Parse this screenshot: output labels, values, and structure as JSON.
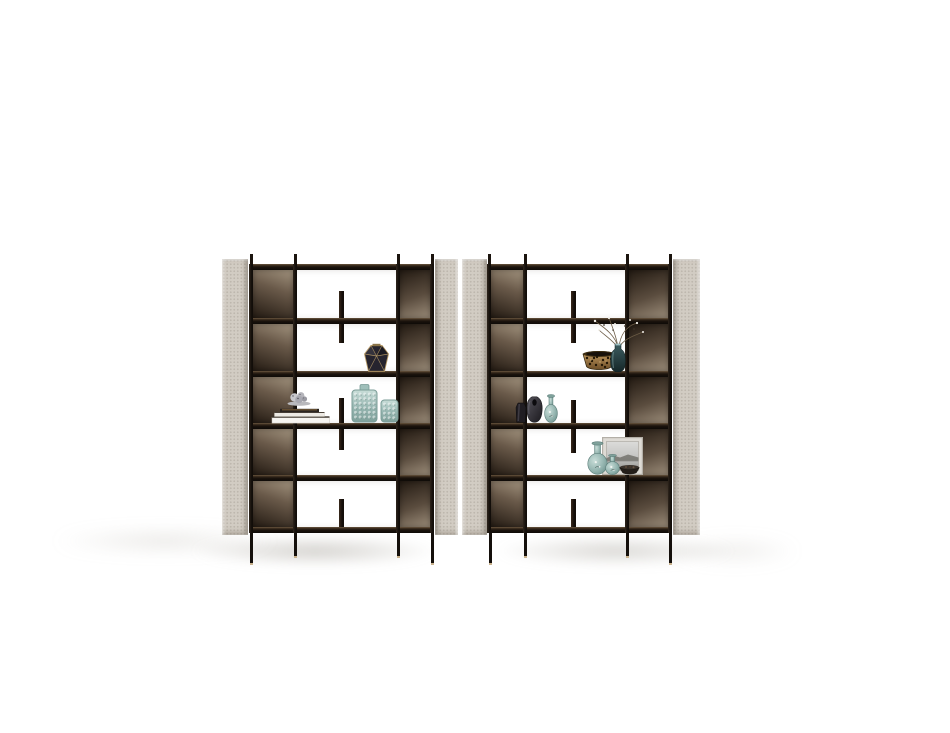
{
  "scene": {
    "subject": "product-photo-two-modern-bookcase-units-with-decor",
    "background": "#ffffff"
  },
  "palette": {
    "panel_fabric": "#d2ccc3",
    "frame_dark": "#171210",
    "bronze_light": "#a3947f",
    "bronze_dark": "#241b13",
    "teal_light": "#c8ddd8",
    "teal_mid": "#95b5b0",
    "teal_dark": "#5f837e",
    "gold": "#b79a66",
    "leg_foot": "#c9b28d"
  },
  "metrics": {
    "canvas_w": 950,
    "canvas_h": 733,
    "rail_ys": [
      264,
      318,
      371,
      423,
      475,
      527
    ],
    "rail_h": 6,
    "post_w": 4,
    "divider_w": 5,
    "stub_h": 10,
    "panel_top": 259,
    "panel_bottom": 535,
    "leg_top": 533
  },
  "shadows": [
    {
      "x": 150,
      "y": 530,
      "w": 330,
      "h": 42,
      "color": "rgba(148,143,133,0.40)",
      "blur": 5
    },
    {
      "x": 455,
      "y": 530,
      "w": 320,
      "h": 42,
      "color": "rgba(148,143,133,0.34)",
      "blur": 5
    },
    {
      "x": 15,
      "y": 526,
      "w": 300,
      "h": 30,
      "color": "rgba(170,165,155,0.30)",
      "blur": 8
    },
    {
      "x": 650,
      "y": 534,
      "w": 170,
      "h": 34,
      "color": "rgba(170,165,155,0.22)",
      "blur": 8
    }
  ],
  "units": [
    {
      "id": "bookcase-left",
      "side_panels": [
        {
          "x": 222,
          "w": 26,
          "flip": false
        },
        {
          "x": 435,
          "w": 23,
          "flip": true
        }
      ],
      "posts": [
        249,
        293,
        396,
        430
      ],
      "rail_x": 249,
      "rail_w": 185,
      "bronze_columns": [
        {
          "x": 253,
          "w": 40,
          "light": "top"
        },
        {
          "x": 400,
          "w": 30,
          "light": "bottom"
        }
      ],
      "middle": {
        "x": 297,
        "w": 99
      },
      "dividers": [
        {
          "x": 339,
          "y": 291,
          "h": 52
        },
        {
          "x": 339,
          "y": 398,
          "h": 52
        },
        {
          "x": 339,
          "y": 499,
          "h": 28
        }
      ],
      "legs": [
        {
          "x": 250,
          "h": 30
        },
        {
          "x": 294,
          "h": 23
        },
        {
          "x": 397,
          "h": 23
        },
        {
          "x": 431,
          "h": 30
        }
      ]
    },
    {
      "id": "bookcase-right",
      "side_panels": [
        {
          "x": 462,
          "w": 25,
          "flip": false
        },
        {
          "x": 673,
          "w": 27,
          "flip": true
        }
      ],
      "posts": [
        487,
        523,
        625,
        668
      ],
      "rail_x": 487,
      "rail_w": 185,
      "bronze_columns": [
        {
          "x": 491,
          "w": 32,
          "light": "top"
        },
        {
          "x": 629,
          "w": 39,
          "light": "bottom"
        }
      ],
      "middle": {
        "x": 527,
        "w": 98
      },
      "dividers": [
        {
          "x": 571,
          "y": 291,
          "h": 52
        },
        {
          "x": 571,
          "y": 400,
          "h": 53
        },
        {
          "x": 571,
          "y": 499,
          "h": 28
        }
      ],
      "legs": [
        {
          "x": 489,
          "h": 30
        },
        {
          "x": 524,
          "h": 23
        },
        {
          "x": 626,
          "h": 23
        },
        {
          "x": 669,
          "h": 30
        }
      ]
    }
  ],
  "objects": [
    {
      "id": "faceted-vase",
      "type": "facetedVase",
      "x": 363,
      "y": 343,
      "w": 27,
      "h": 29,
      "body": "#26242e",
      "edge": "#b79a66"
    },
    {
      "id": "book-stack",
      "type": "bookStack",
      "x": 271,
      "y": 404,
      "w": 60,
      "h": 20,
      "c1": "#f6f4f0",
      "c2": "#2b2520",
      "c3": "#8a6a3e"
    },
    {
      "id": "silver-sculpture",
      "type": "sculpture",
      "x": 284,
      "y": 390,
      "w": 30,
      "h": 16,
      "c1": "#c8c8cc",
      "c2": "#a8a8b0",
      "c3": "#52525a"
    },
    {
      "id": "teal-textured-vase-tall",
      "type": "tealCylinder",
      "x": 351,
      "y": 384,
      "w": 27,
      "h": 39,
      "cap": true
    },
    {
      "id": "teal-textured-vase-short",
      "type": "tealCylinder",
      "x": 380,
      "y": 398,
      "w": 19,
      "h": 25,
      "cap": false
    },
    {
      "id": "leopard-print-bowl",
      "type": "leopardBowl",
      "x": 582,
      "y": 349,
      "w": 34,
      "h": 23,
      "base": "#c89f63",
      "spot": "#241705",
      "shade": "#6e4f28"
    },
    {
      "id": "dried-flower-vase",
      "type": "flowerArrangement",
      "x": 585,
      "y": 316,
      "w": 60,
      "h": 56,
      "glass1": "#3d5d60",
      "glass2": "#152628",
      "branch": "#6b5b45",
      "blossom": "#f2efe8"
    },
    {
      "id": "black-mini-vase",
      "type": "blackMiniVase",
      "x": 515,
      "y": 402,
      "w": 12,
      "h": 21,
      "body": "#201d22"
    },
    {
      "id": "charcoal-vase",
      "type": "charcoalVase",
      "x": 526,
      "y": 396,
      "w": 17,
      "h": 27,
      "c1": "#55535b",
      "c2": "#1b191e"
    },
    {
      "id": "teal-gourd-vase-a",
      "type": "tealGourd",
      "x": 544,
      "y": 394,
      "w": 14,
      "h": 29
    },
    {
      "id": "photo-frame",
      "type": "photoFrame",
      "x": 602,
      "y": 437,
      "w": 41,
      "h": 38,
      "frame": "#dedbd5",
      "sky": "#dcdcda",
      "land": "#6f6e68"
    },
    {
      "id": "teal-gourd-vase-b",
      "type": "tealGourd",
      "x": 587,
      "y": 441,
      "w": 21,
      "h": 34
    },
    {
      "id": "teal-gourd-vase-c",
      "type": "tealGourd",
      "x": 605,
      "y": 454,
      "w": 15,
      "h": 21
    },
    {
      "id": "dark-bowl",
      "type": "darkBowl",
      "x": 619,
      "y": 464,
      "w": 21,
      "h": 11,
      "body": "#241e19"
    }
  ]
}
